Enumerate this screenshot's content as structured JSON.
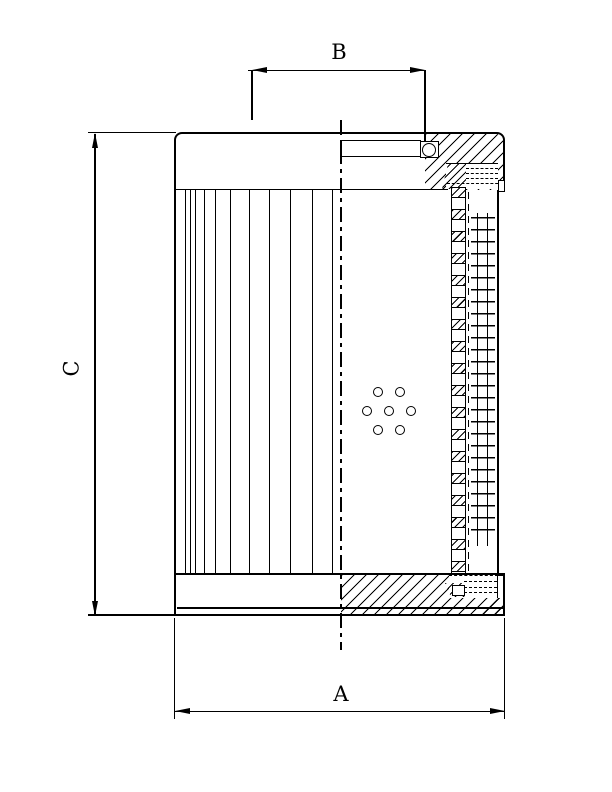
{
  "figure": {
    "kind": "technical section drawing",
    "dim_labels": {
      "overall_width": "A",
      "collar_width": "B",
      "overall_height": "C"
    }
  },
  "colors": {
    "ink": "#000000",
    "paper": "#ffffff"
  },
  "pleats": {
    "x_positions": [
      183,
      188,
      193,
      202,
      213,
      228,
      247,
      267,
      288,
      310,
      330
    ]
  },
  "perforation_holes": {
    "diameter": 11,
    "centers": [
      [
        378,
        392
      ],
      [
        400,
        392
      ],
      [
        367,
        411
      ],
      [
        389,
        411
      ],
      [
        411,
        411
      ],
      [
        378,
        430
      ],
      [
        400,
        430
      ]
    ]
  }
}
